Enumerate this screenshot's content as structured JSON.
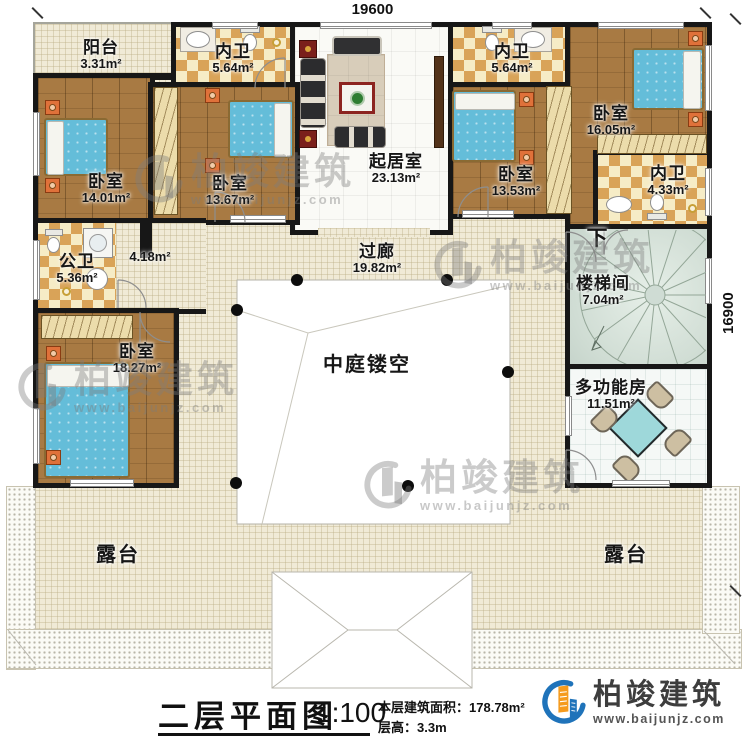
{
  "dimensions": {
    "top": "19600",
    "right": "16900"
  },
  "rooms": {
    "balcony": {
      "name": "阳台",
      "area": "3.31m²"
    },
    "bath1": {
      "name": "内卫",
      "area": "5.64m²"
    },
    "bath2": {
      "name": "内卫",
      "area": "5.64m²"
    },
    "bath3": {
      "name": "内卫",
      "area": "4.33m²"
    },
    "public_bath": {
      "name": "公卫",
      "area": "5.36m²"
    },
    "closet": {
      "area": "4.18m²"
    },
    "living": {
      "name": "起居室",
      "area": "23.13m²"
    },
    "bed1": {
      "name": "卧室",
      "area": "14.01m²"
    },
    "bed2": {
      "name": "卧室",
      "area": "13.67m²"
    },
    "bed3": {
      "name": "卧室",
      "area": "13.53m²"
    },
    "bed4": {
      "name": "卧室",
      "area": "16.05m²"
    },
    "bed5": {
      "name": "卧室",
      "area": "18.27m²"
    },
    "corridor": {
      "name": "过廊",
      "area": "19.82m²"
    },
    "atrium": {
      "name": "中庭镂空"
    },
    "stairwell": {
      "name": "楼梯间",
      "area": "7.04m²",
      "direction": "下"
    },
    "multi": {
      "name": "多功能房",
      "area": "11.51m²"
    },
    "terrace_left": {
      "name": "露台"
    },
    "terrace_right": {
      "name": "露台"
    }
  },
  "watermark": {
    "brand": "柏竣建筑",
    "url": "www.baijunjz.com"
  },
  "footer": {
    "title": "二层平面图",
    "scale": "1:100",
    "area_label": "本层建筑面积：",
    "area_value": "178.78m²",
    "height_label": "层高：",
    "height_value": "3.3m",
    "brand": "柏竣建筑",
    "brand_url": "www.baijunjz.com"
  },
  "colors": {
    "wall": "#171717",
    "wood_floor": "#a87a43",
    "tile_check": "#d9a358",
    "corridor_floor": "#f0ead6",
    "bed_blue": "#64bdd9",
    "table_teal": "#9ed8da",
    "logo_blue": "#1f73ba",
    "logo_orange": "#f59b1e"
  }
}
